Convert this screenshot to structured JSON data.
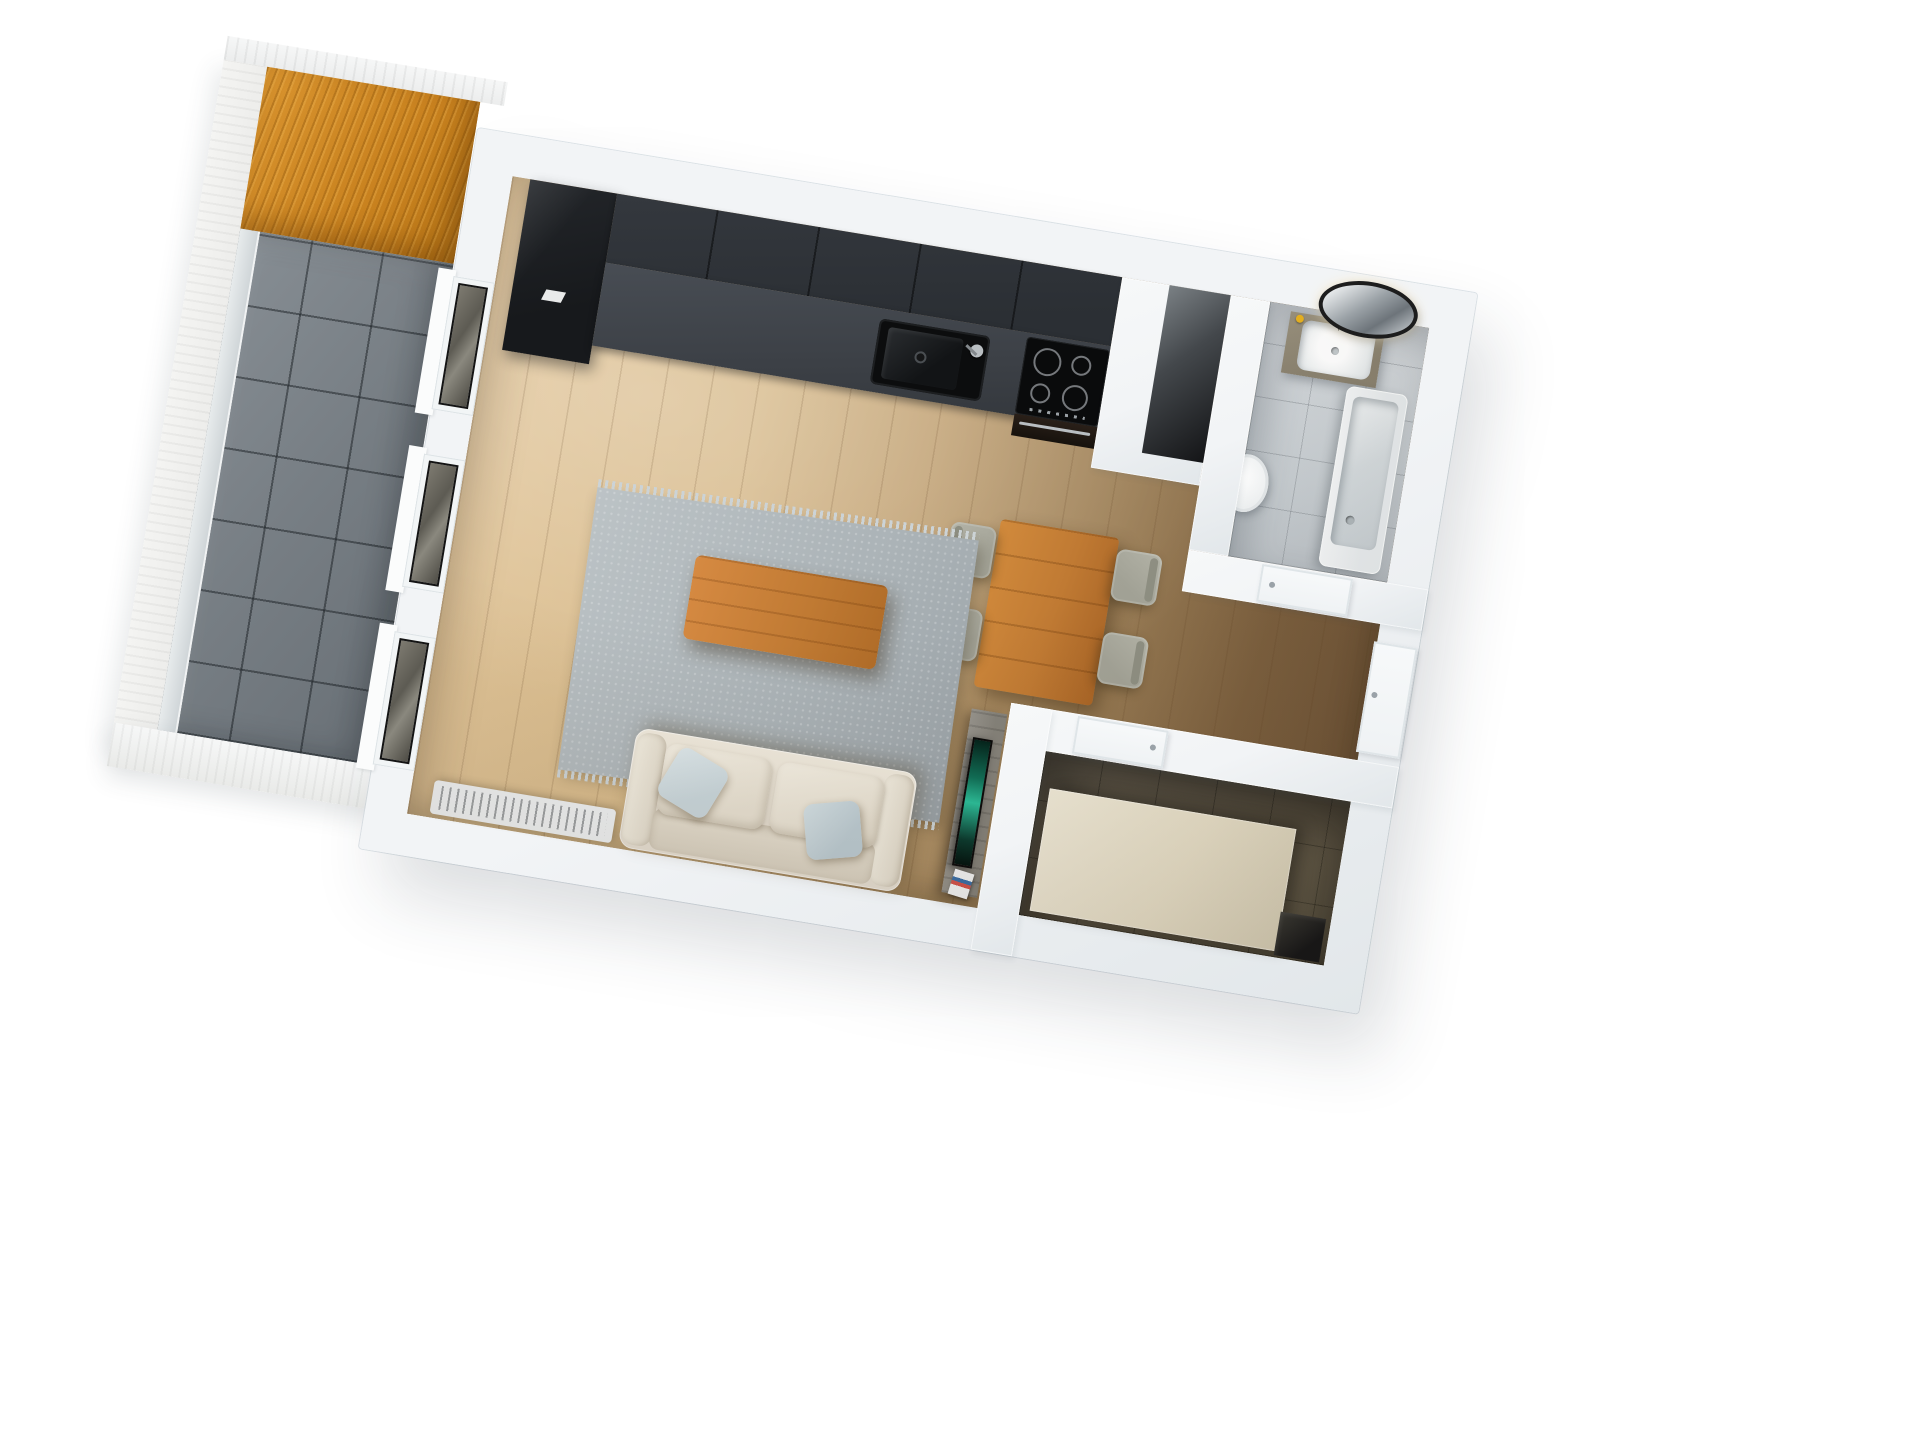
{
  "scene": {
    "type": "3d-floorplan-render",
    "view": "top-down bird's-eye view of a studio apartment",
    "background": "#ffffff",
    "rotation_deg": 9.4
  },
  "colors": {
    "wall": "#f2f4f6",
    "wall-edge": "#e2e7ea",
    "oak-light": "#e2c69a",
    "walnut": "#7b5f3e",
    "balcony-tile": "#878e94",
    "canopy-wood": "#d8932e",
    "slab-white": "#ededeb",
    "glass-pane": "#cdd3d6",
    "rug": "#aab2b6",
    "rug-fringe": "#ccd3d6",
    "sofa": "#e6dfd2",
    "pillow": "#c9d6db",
    "wood-orange": "#c07a33",
    "chair": "#a2a296",
    "kitchen-black": "#17191c",
    "kitchen-upper": "#2b2f34",
    "kitchen-counter": "#3c4046",
    "appliance": "#17120d",
    "steel": "#b9bec2",
    "bath-tile": "#d7dbdf",
    "vanity-wood": "#8a8270",
    "white-fixture": "#eef1f2",
    "tub": "#e6eaec",
    "tub-inner": "#d3d9dc",
    "soap-yellow": "#e8b21f",
    "dress-tile": "#7a7160",
    "beige": "#e7dfc8",
    "tv-screen": "#2bbf9a",
    "tv-console": "#85827a",
    "door-white": "#eff2f4",
    "radiator": "#eef0f1",
    "shaft-dark": "#141517",
    "window-glass": "#4e4c45"
  },
  "rooms": [
    {
      "id": "living-kitchen",
      "name": "open-plan living room with kitchen",
      "floor": "light oak plank"
    },
    {
      "id": "hallway",
      "name": "entrance hallway",
      "floor": "dark walnut plank"
    },
    {
      "id": "bathroom",
      "name": "bathroom",
      "floor": "light grey tile"
    },
    {
      "id": "dressing-room",
      "name": "small room with beige bed/wardrobe",
      "floor": "olive-brown tile"
    },
    {
      "id": "balcony",
      "name": "balcony with wood canopy",
      "floor": "grey stone tile"
    }
  ],
  "furniture": {
    "kitchen": [
      "tall black cabinet",
      "black upper cabinets",
      "graphite counter",
      "black sink with faucet",
      "induction cooktop with 4 burners",
      "oven with steel handle"
    ],
    "living": [
      "wooden dining table",
      "4 grey chairs",
      "grey fringed area rug",
      "wooden coffee table",
      "cream sofa with 2 blue-grey pillows",
      "white radiator",
      "grey TV sideboard",
      "flat TV with teal screen",
      "magazine"
    ],
    "bathroom": [
      "wood vanity with white basin",
      "round black-rim mirror",
      "white toilet",
      "white bathtub"
    ],
    "dressing-room": [
      "large beige bed / wardrobe panel",
      "dark corner shaft"
    ],
    "balcony": [
      "glass railing panel",
      "orange wood canopy",
      "white slab edge"
    ]
  },
  "doors": [
    "entrance door on right wall",
    "bathroom door",
    "dressing room door"
  ],
  "windows": [
    "living room window 1",
    "living room window 2",
    "balcony door window"
  ],
  "shafts": [
    "ventilation shaft between kitchen and bathroom",
    "corner shaft in dressing room"
  ]
}
